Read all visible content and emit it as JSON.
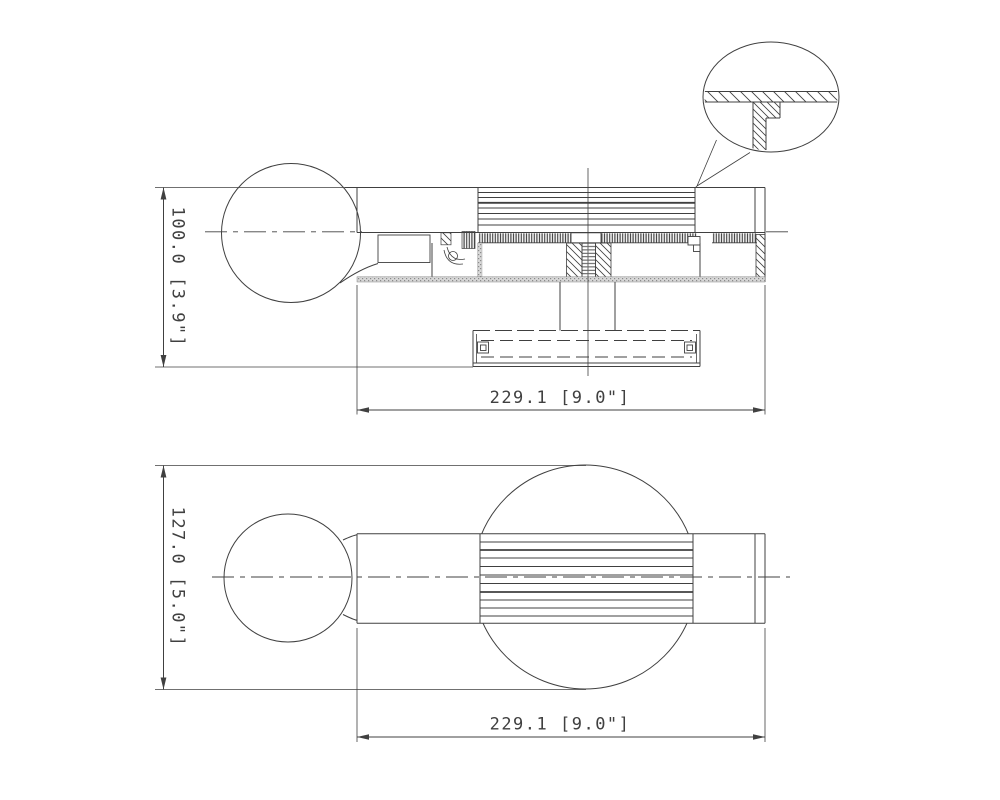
{
  "drawing": {
    "background": "#ffffff",
    "line_color": "#404040",
    "section_view": {
      "height_dim": "100.0 [3.9\"]",
      "width_dim": "229.1 [9.0\"]"
    },
    "plan_view": {
      "height_dim": "127.0 [5.0\"]",
      "width_dim": "229.1 [9.0\"]"
    }
  }
}
